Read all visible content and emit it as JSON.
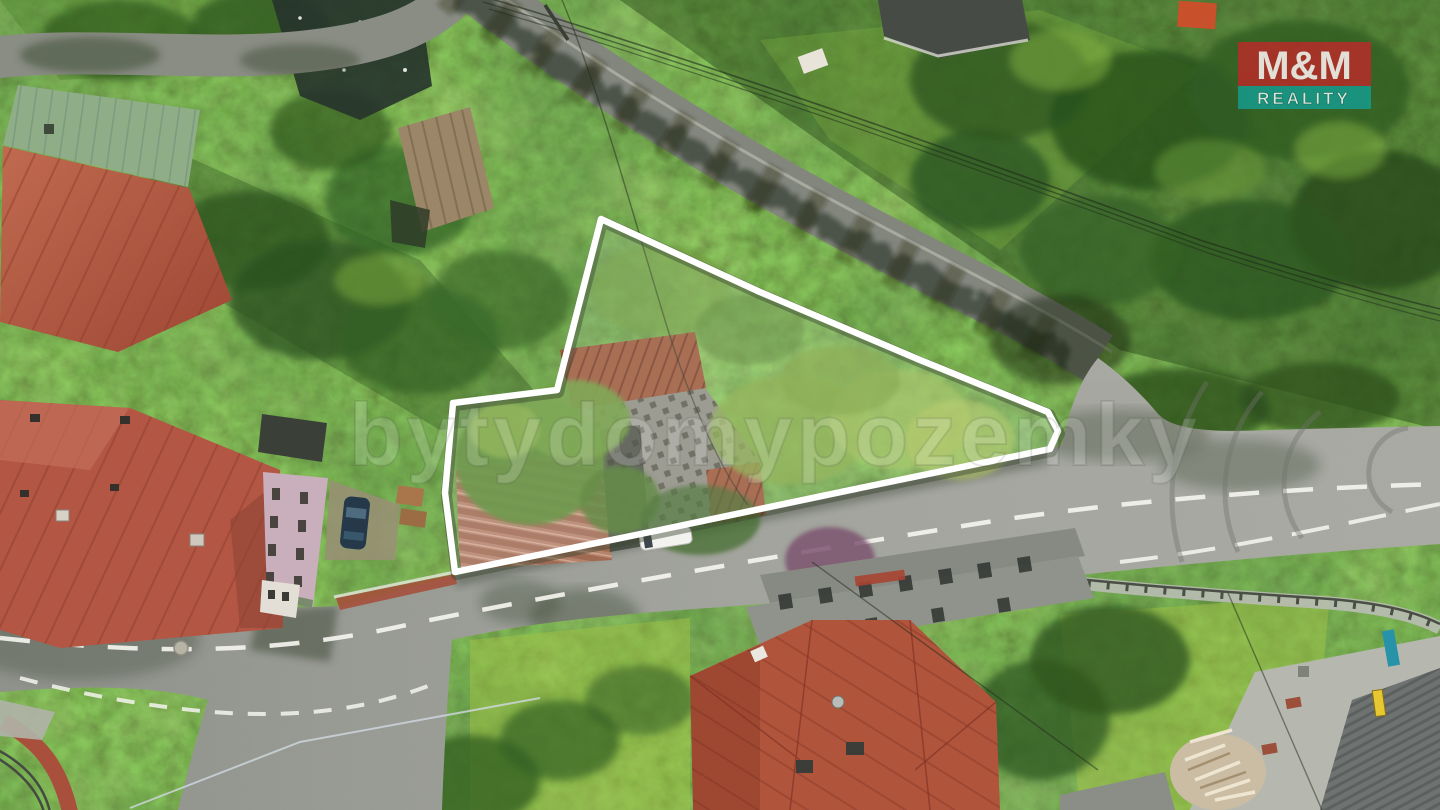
{
  "photo": {
    "kind": "aerial-drone-photo-of-property-for-sale"
  },
  "watermark": {
    "text": "bytydomypozemky",
    "color": "#ffffff"
  },
  "logo": {
    "line1": "M&M",
    "line2": "REALITY",
    "top_bg": "#cf2229",
    "bottom_bg": "#12a29b",
    "text_color": "#ffffff"
  },
  "property": {
    "outline_color": "#ffffff"
  },
  "palette": {
    "foliage_base": "#51802e",
    "forest_dark": "#1e3d14",
    "grass_bright": "#a6c545",
    "road": "#9a9d97",
    "upper_road": "#83867d",
    "roof_red_complex": "#b35644",
    "roof_green_metal": "#8fae87",
    "roof_rust_ruin": "#9c5a3c",
    "roof_red_house": "#b0543c",
    "gray_outbuilding": "#90938b",
    "concrete": "#b6b8b0",
    "dark_roof_corner": "#6e7270"
  }
}
